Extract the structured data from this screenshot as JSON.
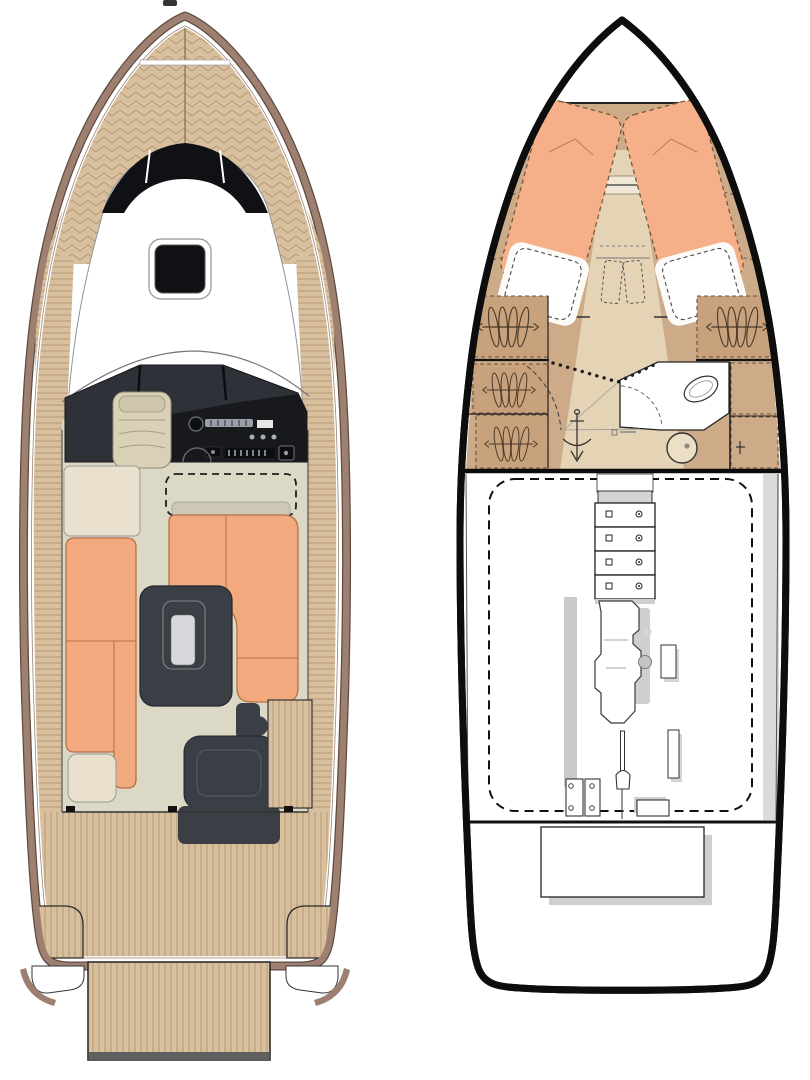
{
  "page": {
    "background": "#ffffff"
  },
  "palette": {
    "teak": "#d8bf9d",
    "teak-line": "#b29674",
    "hull-trim": "#9d8070",
    "hull-trim-dark": "#5f4b41",
    "roof-line": "#8f959b",
    "glass": "#101114",
    "windshield": "#2e3138",
    "console": "#17191d",
    "cushion": "#f3a97e",
    "cushion-line": "#b96f45",
    "floor": "#dcd8c6",
    "cream": "#e9e1cd",
    "seat-khaki": "#d9d1b6",
    "backrest": "#ccc8b5",
    "dark-module": "#3a3e45",
    "cabin-tan": "#cdab88",
    "cabin-tan-dark": "#c8a27c",
    "aisle": "#e4d3b5",
    "berth": "#f5b089",
    "toilet-fill": "#ecdfc6",
    "shadow": "#c9c9c9",
    "ink": "#1a1a1a",
    "hanger-ink": "#4d3a28"
  },
  "figure": {
    "left_plan": {
      "name": "main-deck-plan",
      "features": [
        "bow-teak-deck",
        "bow-hatch",
        "windscreen",
        "cabin-roof",
        "wraparound-windshield",
        "helm-console",
        "companion-seat",
        "side-cabinet",
        "canopy-dashed-outline",
        "l-settee",
        "port-bench",
        "bench-end-table",
        "cockpit-table",
        "aft-seat-module",
        "wet-bar",
        "aft-teak-deck",
        "stern-locker-port",
        "stern-locker-starboard",
        "swim-platform"
      ]
    },
    "right_plan": {
      "name": "lower-deck-plan",
      "features": [
        "forepeak",
        "v-berth-port",
        "v-berth-starboard",
        "pillow-port",
        "pillow-starboard",
        "hanging-lockers",
        "companionway-steps",
        "head-compartment",
        "toilet",
        "sink",
        "sliding-door-track",
        "bulkhead",
        "engine-room",
        "drawer-unit",
        "engine",
        "prop-shaft",
        "shaft-plates",
        "transom-locker"
      ]
    }
  }
}
